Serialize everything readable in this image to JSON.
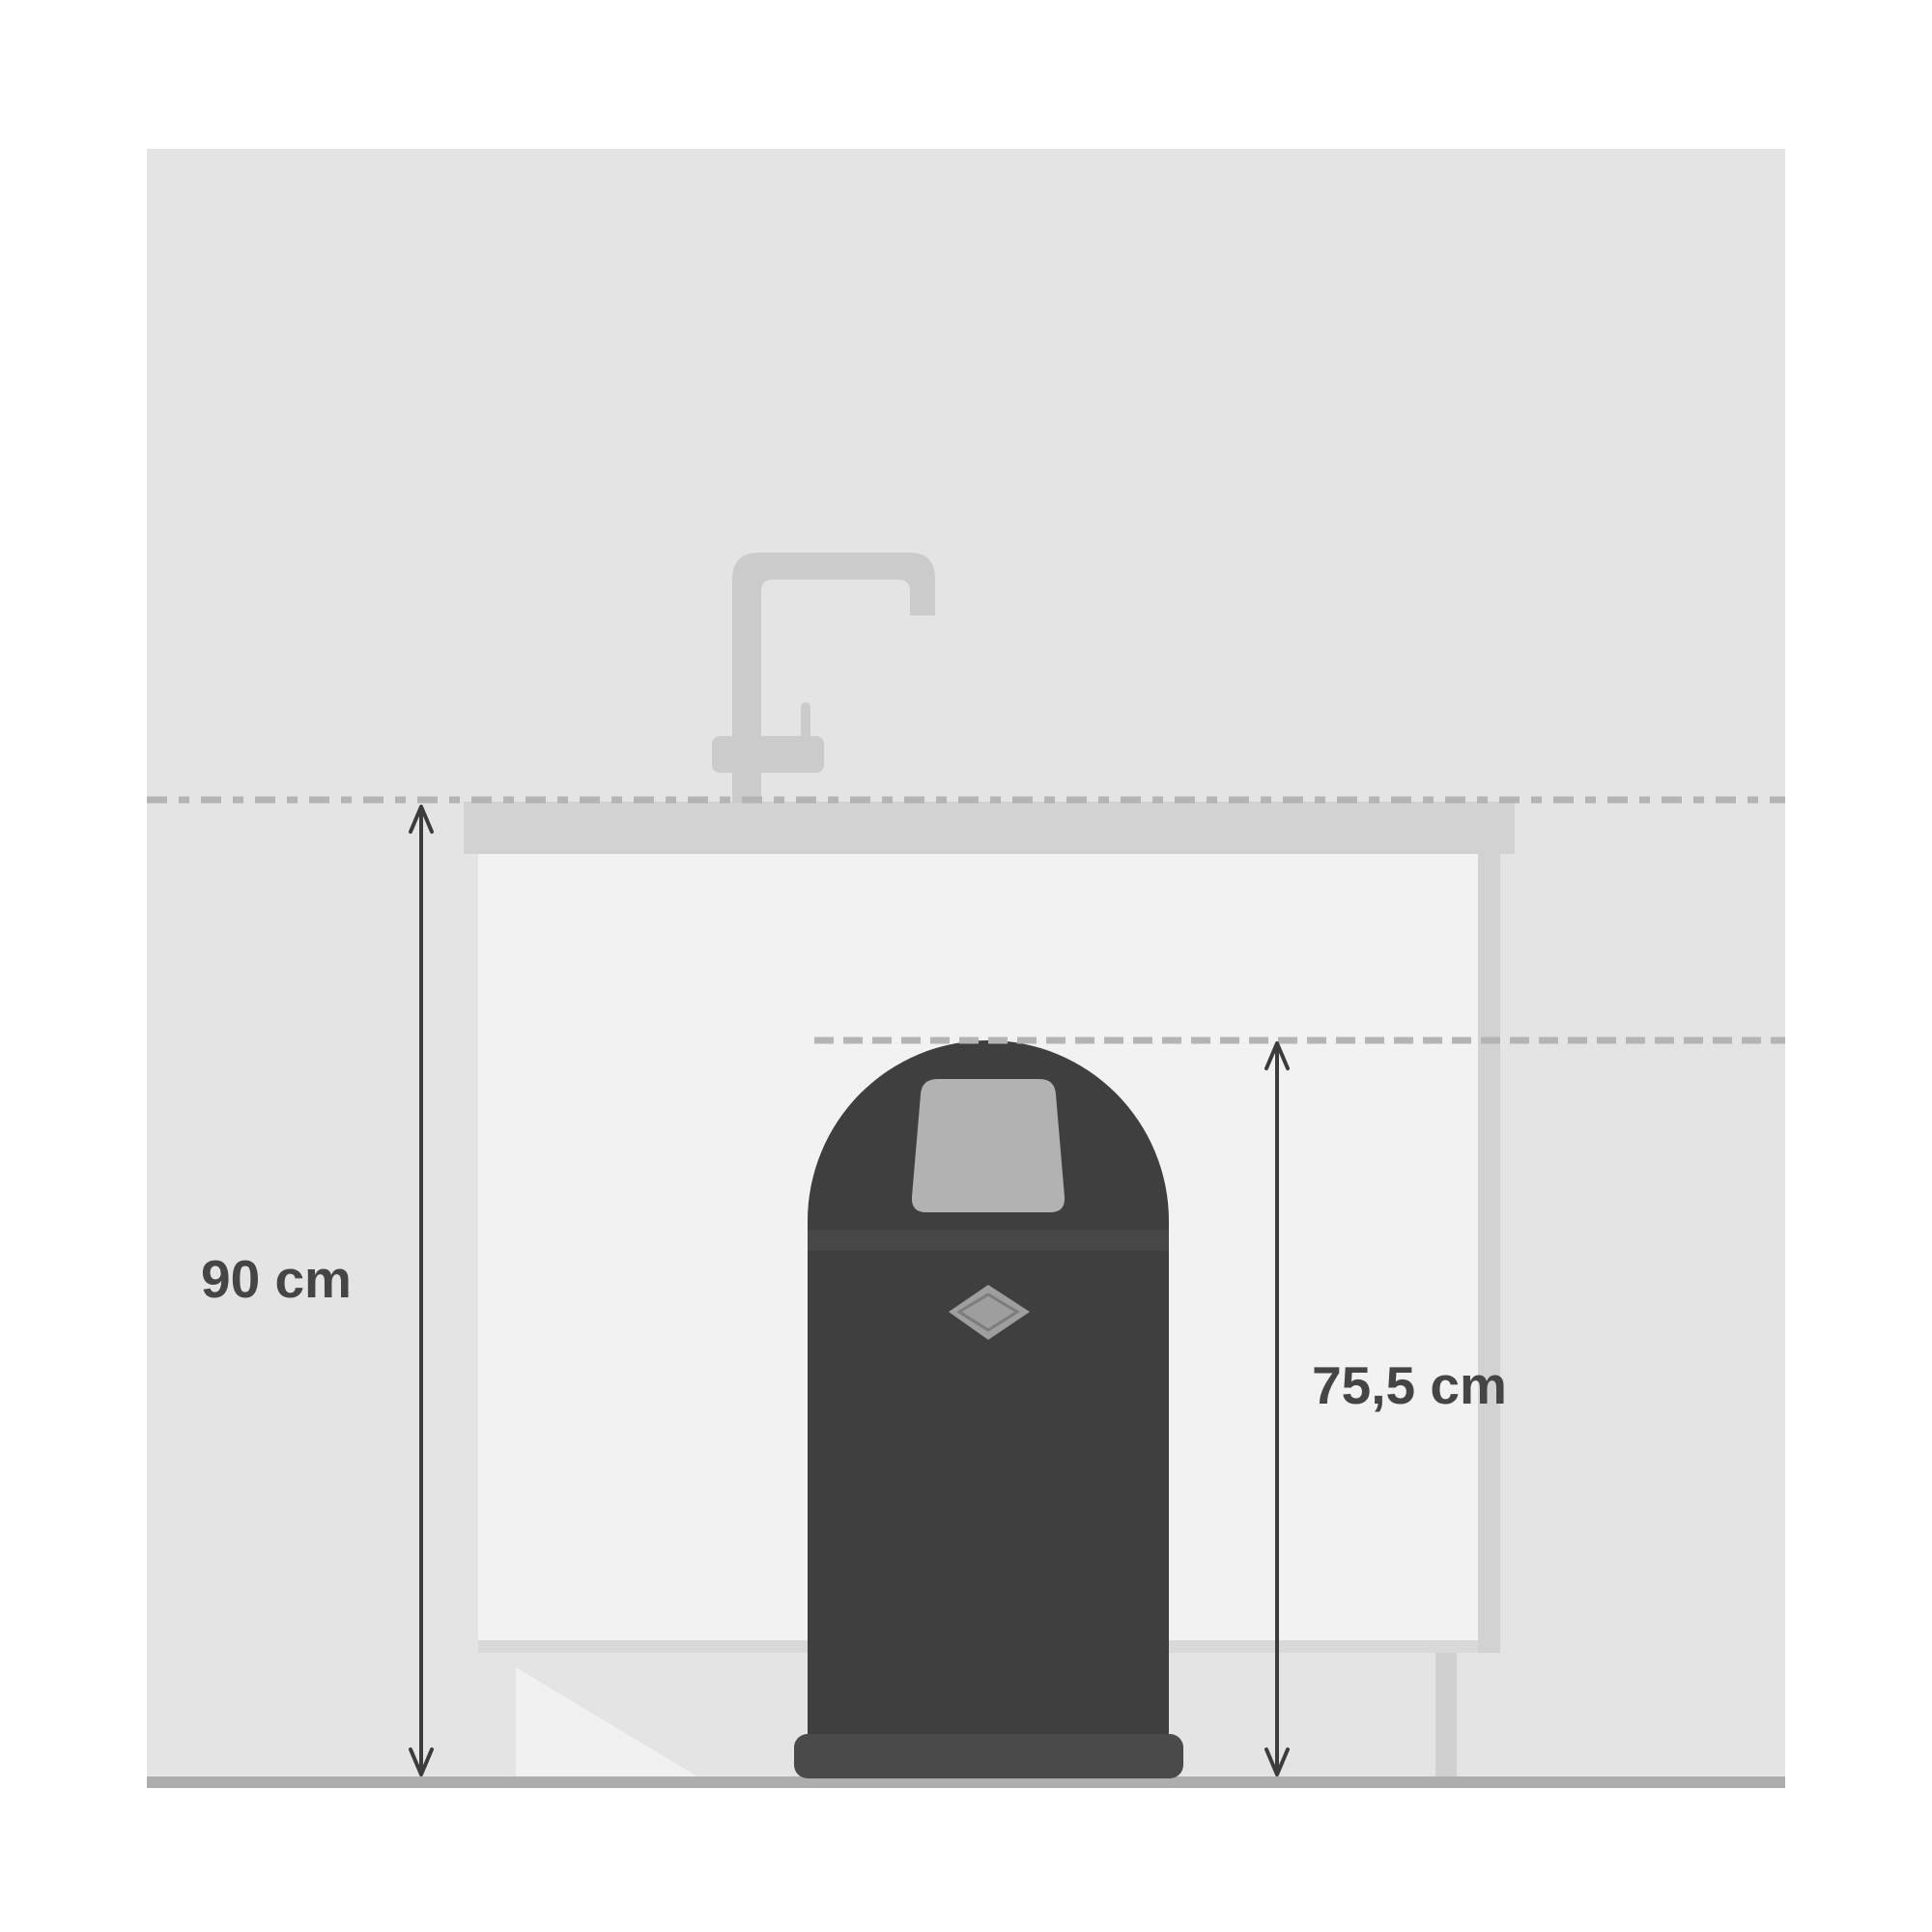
{
  "page": {
    "background_color": "#ffffff"
  },
  "diagram": {
    "type": "product-dimension-illustration",
    "subject": "push-bin standing in front of kitchen counter recess",
    "labels": {
      "counter_height": "90 cm",
      "bin_height": "75,5 cm"
    },
    "colors": {
      "wall": "#e4e4e4",
      "counter": "#d2d2d2",
      "recess": "#f2f2f2",
      "recess_shadow": "#d9d9d9",
      "cabinet_side": "#d2d2d2",
      "cabinet_leg": "#d0d0d0",
      "door_highlight": "#f1f1f1",
      "faucet": "#cbcbcb",
      "floor": "#aeaeae",
      "dash_line": "#b4b4b4",
      "bin_body": "#3f3f3f",
      "bin_lid_band": "#484848",
      "bin_base": "#4a4a4a",
      "bin_flap": "#b2b2b2",
      "bin_emblem": "#9e9e9e",
      "bin_emblem_outline": "#7d7d7d",
      "arrow": "#3c3c3c",
      "label_text": "#454545"
    },
    "icons": {
      "faucet": "faucet-icon",
      "bin": "push-bin-icon",
      "emblem": "diamond-emblem-icon",
      "level_lines": "dashed-level-line",
      "arrows": "dimension-arrow"
    }
  }
}
